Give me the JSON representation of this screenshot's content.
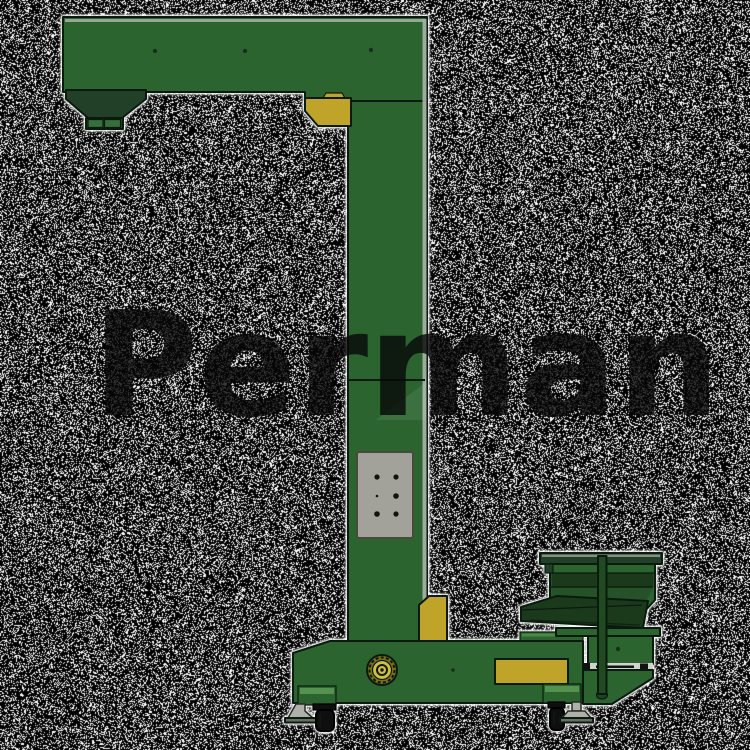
{
  "watermark": {
    "text": "Perman"
  },
  "illustration": {
    "subject": "green z-type bucket elevator machine, side view",
    "parts": [
      "top-discharge-boom",
      "discharge-hopper",
      "discharge-outlet",
      "yellow-corner-bracket",
      "vertical-elevator-column",
      "access-panel",
      "yellow-foot-wedge",
      "base-frame",
      "drive-pulley",
      "yellow-base-plate",
      "infeed-vibration-hopper",
      "infeed-chute",
      "support-rod",
      "caster-wheels",
      "leveling-feet"
    ]
  },
  "colors": {
    "outline": "#0b1a0e",
    "green": "#2c6430",
    "green-dark": "#224028",
    "green-darker": "#1b3a1c",
    "green-mid": "#26522a",
    "green-light": "#35703a",
    "green-band": "#55924f",
    "yellow": "#bfa429",
    "yellow-bright": "#d2be3a",
    "olive": "#7a7020",
    "panel": "#a3a29a",
    "panel-border": "#4a4a3c",
    "edge-light": "#aab3a8",
    "foot-gray": "#aeb1a9",
    "caster": "#0e0e0e",
    "noise-black": "#000000",
    "noise-white": "#ffffff",
    "watermark": "#080808"
  },
  "background": {
    "noise_white_density": 0.28
  }
}
